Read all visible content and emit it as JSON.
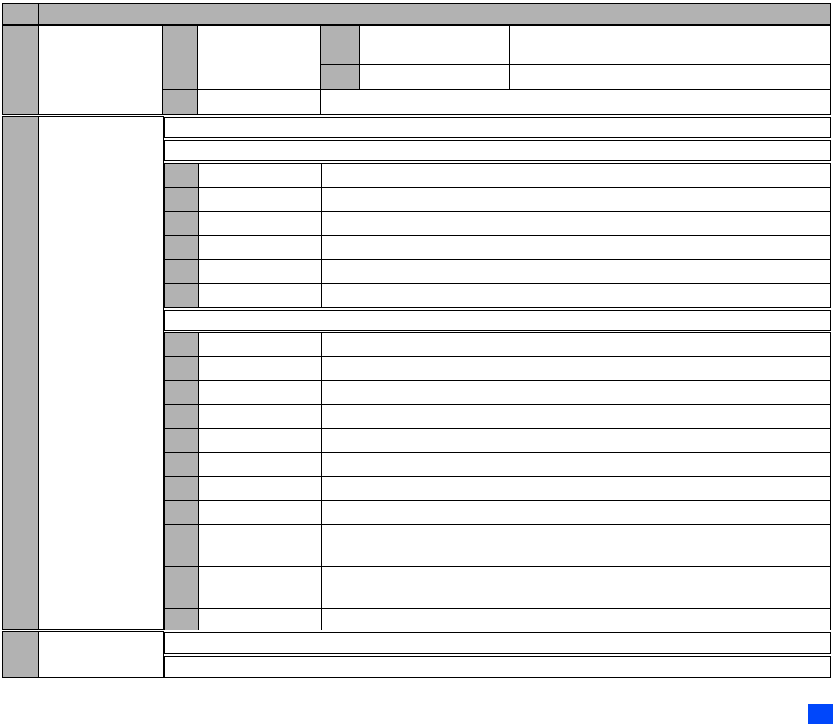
{
  "page": {
    "width": 834,
    "height": 724,
    "background_color": "#ffffff"
  },
  "table_skeleton": {
    "border_color": "#000000",
    "header_fill_color": "#b2b2b2",
    "all_cells_empty": true,
    "header_bar": {
      "index_cell_text": "",
      "title_cell_text": ""
    },
    "top_section": {
      "row1": {
        "label_cell": "",
        "value_cell": "",
        "sub_label_cell": "",
        "sub_value_cell": "",
        "wide_cell": ""
      },
      "row2": {
        "sub_label_cell": "",
        "sub_value_cell": "",
        "wide_cell": ""
      },
      "row3": {
        "label_cell": "",
        "value_cell": "",
        "wide_cell": ""
      }
    },
    "main_section": {
      "intro_rows": [
        "",
        ""
      ],
      "group1_rows": [
        {
          "label": "",
          "value": "",
          "wide": ""
        },
        {
          "label": "",
          "value": "",
          "wide": ""
        },
        {
          "label": "",
          "value": "",
          "wide": ""
        },
        {
          "label": "",
          "value": "",
          "wide": ""
        },
        {
          "label": "",
          "value": "",
          "wide": ""
        },
        {
          "label": "",
          "value": "",
          "wide": ""
        }
      ],
      "separator_row": "",
      "group2_rows": [
        {
          "label": "",
          "value": "",
          "wide": ""
        },
        {
          "label": "",
          "value": "",
          "wide": ""
        },
        {
          "label": "",
          "value": "",
          "wide": ""
        },
        {
          "label": "",
          "value": "",
          "wide": ""
        },
        {
          "label": "",
          "value": "",
          "wide": ""
        },
        {
          "label": "",
          "value": "",
          "wide": ""
        },
        {
          "label": "",
          "value": "",
          "wide": ""
        },
        {
          "label": "",
          "value": "",
          "wide": ""
        },
        {
          "label": "",
          "value": "",
          "wide": ""
        },
        {
          "label": "",
          "value": "",
          "wide": ""
        },
        {
          "label": "",
          "value": "",
          "wide": ""
        }
      ]
    },
    "footer_section": {
      "label_cell": "",
      "value_cell": "",
      "rows": [
        "",
        ""
      ]
    }
  },
  "page_marker": {
    "shape": "rectangle",
    "color": "#0047fb"
  }
}
